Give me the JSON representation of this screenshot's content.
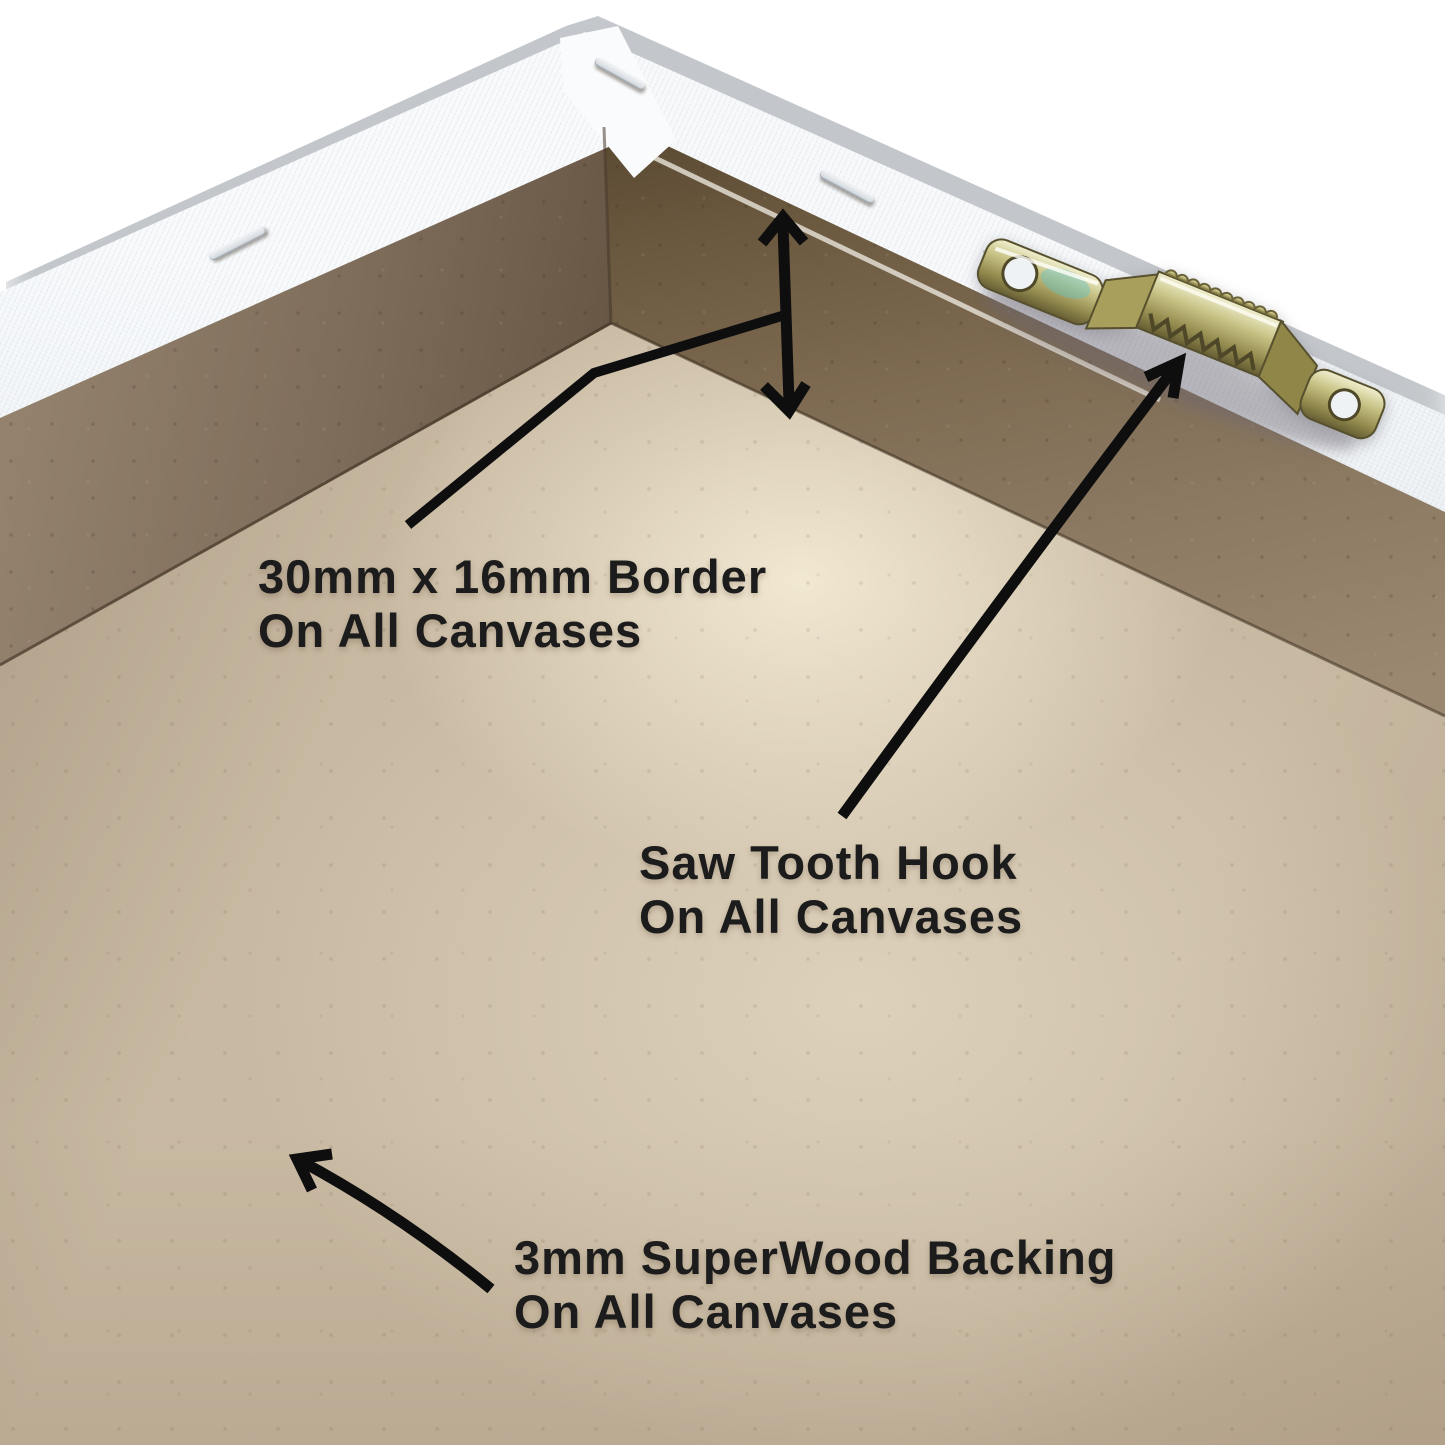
{
  "page": {
    "background_color": "#ffffff",
    "subject": "Back corner of a stretched canvas frame, annotated"
  },
  "labels": {
    "border": {
      "line1": "30mm x 16mm Border",
      "line2": "On All Canvases"
    },
    "saw_tooth": {
      "line1": "Saw Tooth Hook",
      "line2": "On All Canvases"
    },
    "backing": {
      "line1": "3mm SuperWood Backing",
      "line2": "On All Canvases"
    }
  },
  "scene": {
    "parts": [
      {
        "name": "canvas-edge",
        "color": "#eef1f5"
      },
      {
        "name": "mdf-border-frame",
        "color": "#7b6a58"
      },
      {
        "name": "superwood-backing",
        "color": "#c8b9a2"
      },
      {
        "name": "saw-tooth-hook",
        "color": "#b4ab66"
      },
      {
        "name": "staples",
        "color": "#e7ebee"
      }
    ],
    "annotation_style": {
      "text_color": "#1c1c1c",
      "arrow_color": "#0e0e0e"
    }
  }
}
